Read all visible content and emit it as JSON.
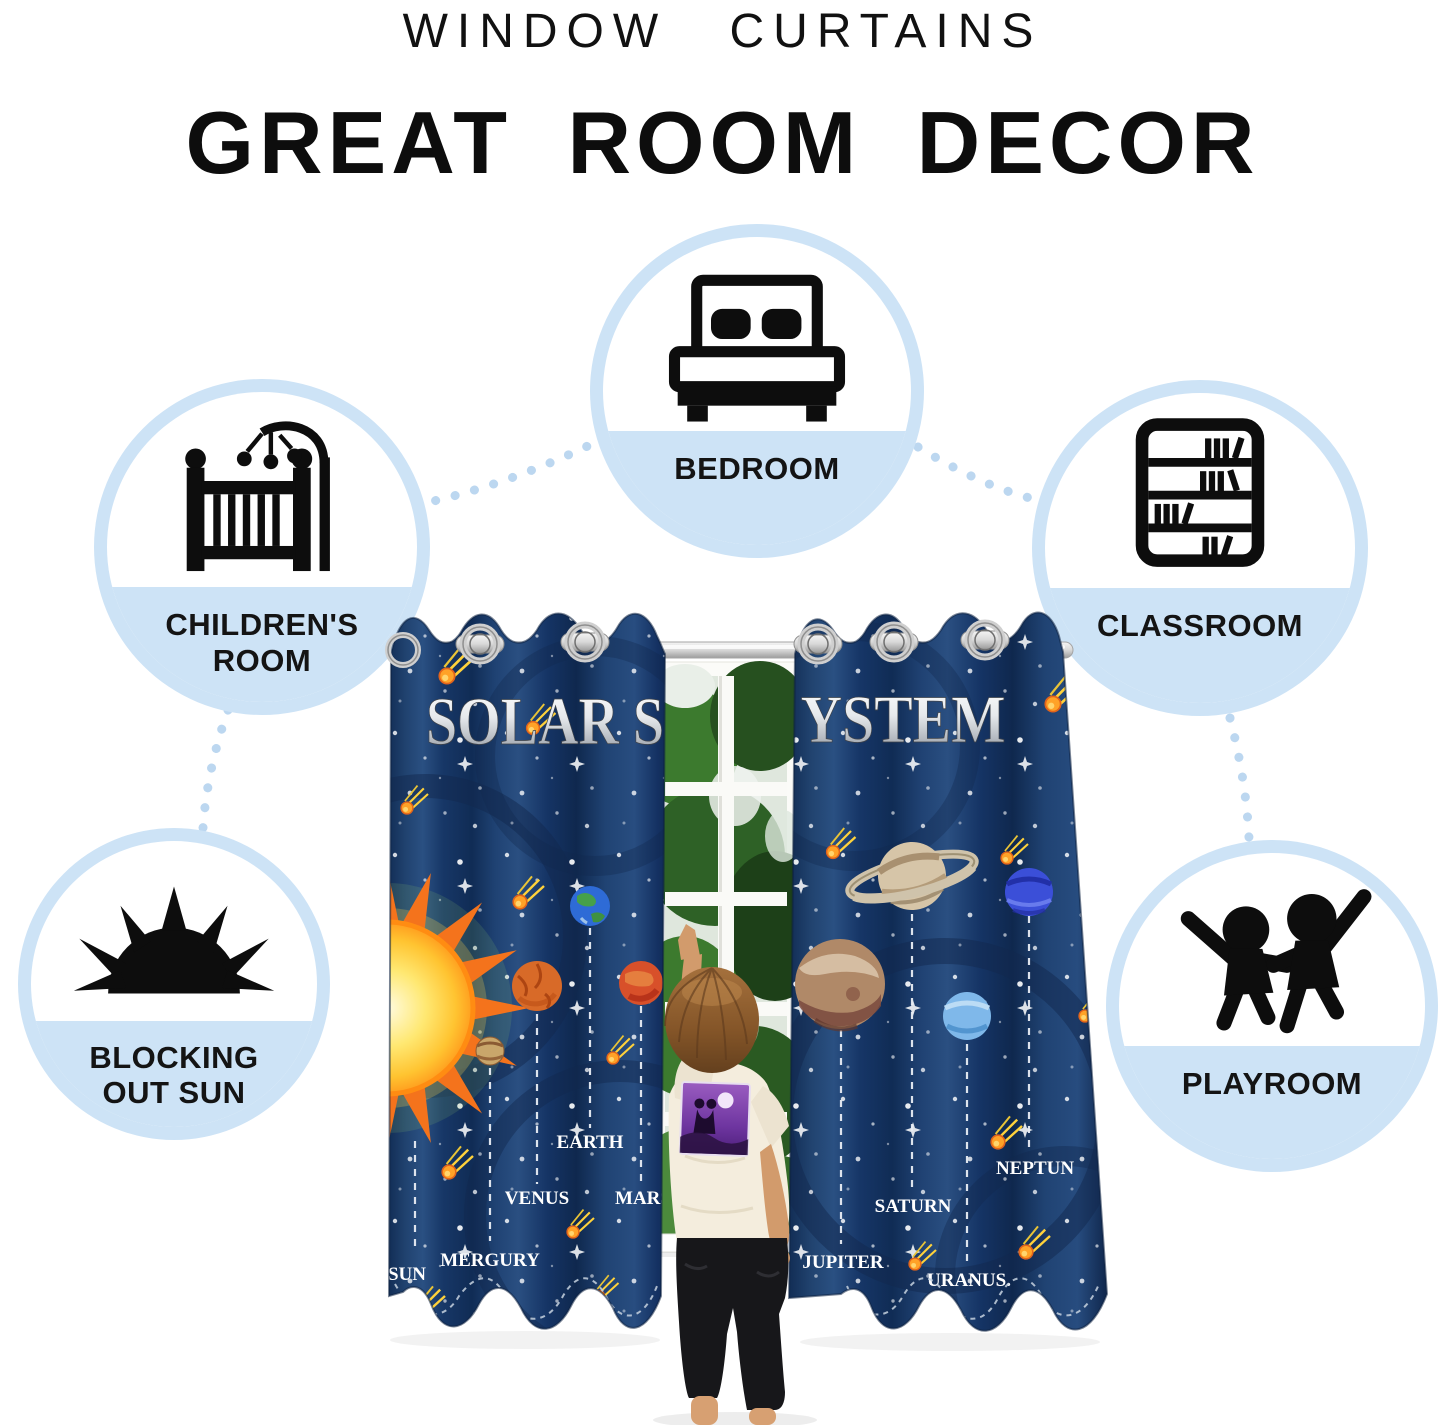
{
  "header": {
    "line1": "WINDOW CURTAINS",
    "line2": "GREAT ROOM DECOR"
  },
  "features": [
    {
      "id": "bedroom",
      "icon": "bed-icon",
      "label1": "BEDROOM",
      "label2": ""
    },
    {
      "id": "childrens-room",
      "icon": "crib-icon",
      "label1": "CHILDREN'S",
      "label2": "ROOM"
    },
    {
      "id": "classroom",
      "icon": "bookshelf-icon",
      "label1": "CLASSROOM",
      "label2": ""
    },
    {
      "id": "blocking-sun",
      "icon": "sun-icon",
      "label1": "BLOCKING",
      "label2": "OUT SUN"
    },
    {
      "id": "playroom",
      "icon": "kids-icon",
      "label1": "PLAYROOM",
      "label2": ""
    }
  ],
  "scene": {
    "headline_left": "SOLAR S",
    "headline_right": "YSTEM",
    "left_labels": [
      "SUN",
      "MERGURY",
      "VENUS",
      "EARTH",
      "MARS"
    ],
    "right_labels": [
      "JUPITER",
      "SATURN",
      "URANUS.",
      "NEPTUN"
    ],
    "colors": {
      "curtain_navy": "#1b3a67",
      "bubble_blue": "#cde3f6",
      "connector_blue": "#bcd7f0",
      "comet_orange": "#ffa227"
    }
  }
}
